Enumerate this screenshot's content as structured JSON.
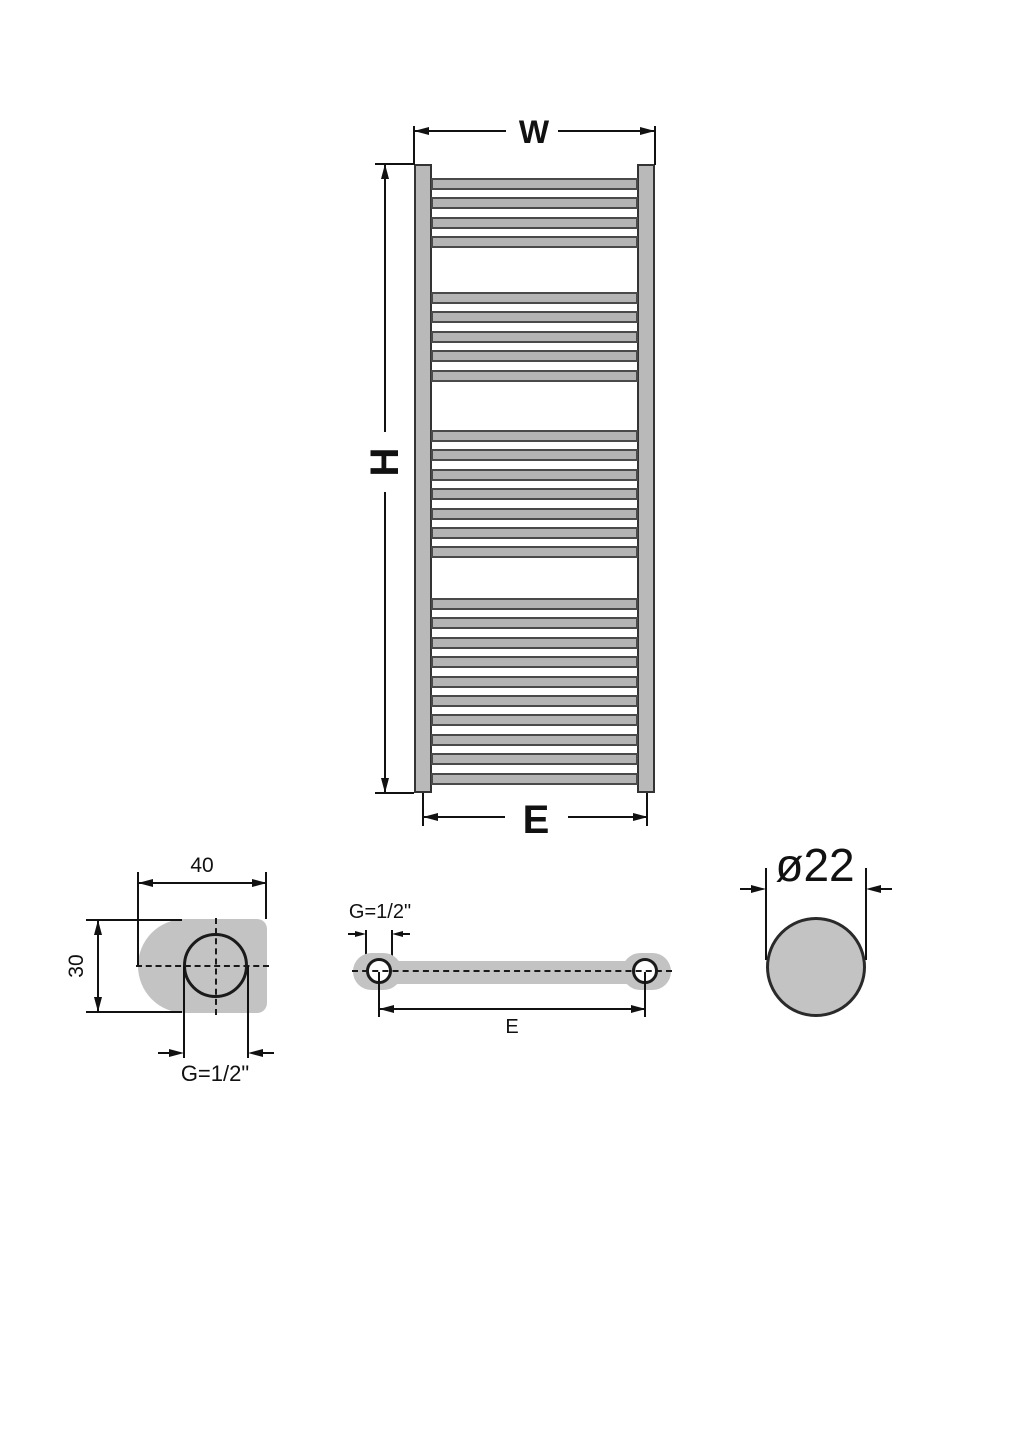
{
  "diagram": {
    "type": "technical-drawing",
    "subject": "heated towel rail radiator dimension drawing",
    "colors": {
      "metal_fill": "#b4b4b4",
      "detail_fill": "#c3c3c3",
      "line": "#111111",
      "background": "#ffffff"
    },
    "front_view": {
      "width_label": "W",
      "height_label": "H",
      "connection_span_label": "E",
      "bar_groups": [
        {
          "count": 4,
          "top": 178
        },
        {
          "count": 5,
          "top": 292
        },
        {
          "count": 7,
          "top": 430
        },
        {
          "count": 10,
          "top": 598
        }
      ],
      "bar_spacing": 19.4,
      "bar_height": 12,
      "total_bars": 26
    },
    "side_view": {
      "width_label": "40",
      "depth_label": "30",
      "thread_label": "G=1/2\""
    },
    "top_view": {
      "thread_label": "G=1/2\"",
      "connection_span_label": "E"
    },
    "tube_detail": {
      "diameter_label": "ø22"
    }
  }
}
